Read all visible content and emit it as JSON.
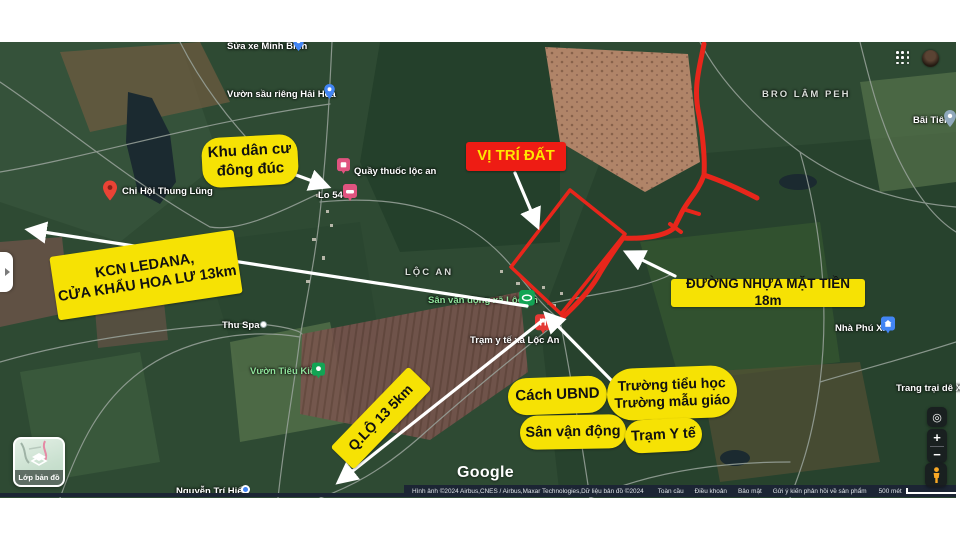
{
  "colors": {
    "callout_yellow": "#f6e204",
    "accent_red": "#ee1c14",
    "attr_navy": "#1c2534",
    "arrow_white": "#ffffff"
  },
  "callouts": {
    "khu_dan_cu": {
      "line1": "Khu dân cư",
      "line2": "đông đúc"
    },
    "vi_tri_dat": {
      "label": "VỊ TRÍ ĐẤT"
    },
    "kcn": {
      "line1": "KCN LEDANA,",
      "line2": "CỬA KHẨU HOA LƯ   13km"
    },
    "duong_nhua": {
      "label": "ĐƯỜNG NHỰA MẶT TIỀN  18m"
    },
    "qlo13": {
      "label": "Q.LỘ 13   5km"
    },
    "cach_ubnd": {
      "label": "Cách UBND"
    },
    "truong": {
      "line1": "Trường tiểu học",
      "line2": "Trường mẫu giáo"
    },
    "san_van_dong": {
      "label": "Sân vận động"
    },
    "tram_y_te": {
      "label": "Trạm Y tế"
    }
  },
  "map_labels": {
    "sua_xe": "Sửa xe Minh Bình",
    "vuon_sau_rieng": "Vườn sầu riêng Hải Hoa",
    "quay_thuoc": "Quầy thuốc lộc an",
    "lo_54": "Lo 54",
    "chi_hoi": "Chi Hội Thung Lũng",
    "bro_lam_peh": "BRO LÂM PEH",
    "bai_tien": "Bãi Tiên",
    "loc_an": "LỘC AN",
    "san_van_dong_xa": "Sân vận động xã Lộc An",
    "tram_y_te_xa": "Trạm y tế xã Lộc An",
    "thu_spa": "Thu Spa",
    "vuon_tieu_kieu": "Vườn Tiêu Kiều",
    "nha_phu_xi": "Nhà Phú Xĩ",
    "trang_trai": "Trang trại dê X-Q",
    "nguyen_tri_hien": "Nguyễn Trí Hiển"
  },
  "map_markers": {
    "hospital_letter": "H"
  },
  "controls": {
    "layers_label": "Lớp bản đồ",
    "zoom_in": "+",
    "zoom_out": "−",
    "compass_glyph": "◎",
    "scale_label": "500 mét",
    "google_logo": "Google"
  },
  "attribution": {
    "imagery": "Hình ảnh ©2024 Airbus,CNES / Airbus,Maxar Technologies,Dữ liệu bản đồ ©2024",
    "links": [
      "Toàn cầu",
      "Điều khoản",
      "Bảo mật",
      "Gửi ý kiến phản hồi về sản phẩm"
    ]
  }
}
